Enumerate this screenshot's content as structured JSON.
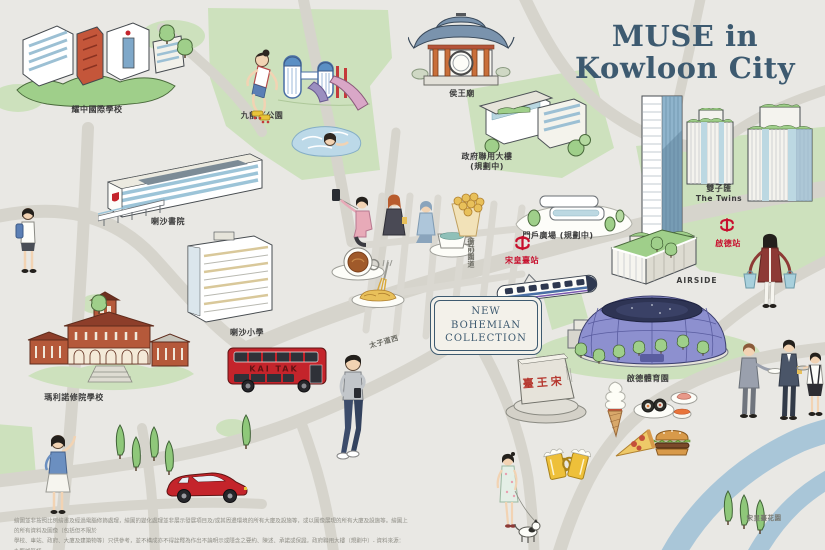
{
  "title": {
    "line1": "MUSE in",
    "line2": "Kowloon City"
  },
  "badge": {
    "line1": "NEW BOHEMIAN",
    "line2": "COLLECTION"
  },
  "labels": {
    "yew_chung_school": "耀中國際學校",
    "kowloon_tsai_park": "九龍仔公園",
    "hau_wong_temple": "侯王廟",
    "govt_joint_building_line1": "政府聯用大樓",
    "govt_joint_building_line2": "(規劃中)",
    "la_salle_college": "喇沙書院",
    "la_salle_primary": "喇沙小學",
    "maryknoll_school": "瑪利諾修院學校",
    "gateway_plaza": "門戶廣場 (規劃中)",
    "sung_wong_toi_station": "宋皇臺站",
    "kai_tak_station": "啟德站",
    "twins_zh": "雙子匯",
    "twins_en": "The Twins",
    "airside": "AIRSIDE",
    "kai_tak_sports_park": "啟德體育園",
    "riverside_garden": "宋皇臺花園"
  },
  "streets": {
    "prince_edward_road_west": "太子道西",
    "nga_tsin_wai_road": "衙前圍道"
  },
  "bus": {
    "route_text": "KAI TAK"
  },
  "monument": {
    "text": "臺王宋"
  },
  "disclaimer": {
    "line1": "繪圖並非按照比例繪畫及經過電腦修飾處理，繪圖的變化處理並非展示發展項目及/或其周邊環境的所有大廈及設施等，或以圖像展現的所有大廈及設施等。繪圖上的所有資料及圖像（包括但不限於",
    "line2": "學校、車站、政府、大廈及建築物等）只供參考，並不構成亦不得詮釋為作出不論明示或隱含之要約、陳述、承諾或保證。政府聯用大樓（規劃中）- 資料來源：九龍城區議",
    "line3": "會文件第31/23號（2025年7月）。門戶廣場（規劃中）- 資料來源：市區重建局《衙前圍道/賈炳達道發展計劃》分區計劃大綱圖 S/K10/URA3/2 啟示圖（2025年7月）。"
  },
  "colors": {
    "accent": "#3d5a70",
    "mtr_red": "#c8102e",
    "park_green": "#cde1bd",
    "river_blue": "#a9c6d8"
  }
}
